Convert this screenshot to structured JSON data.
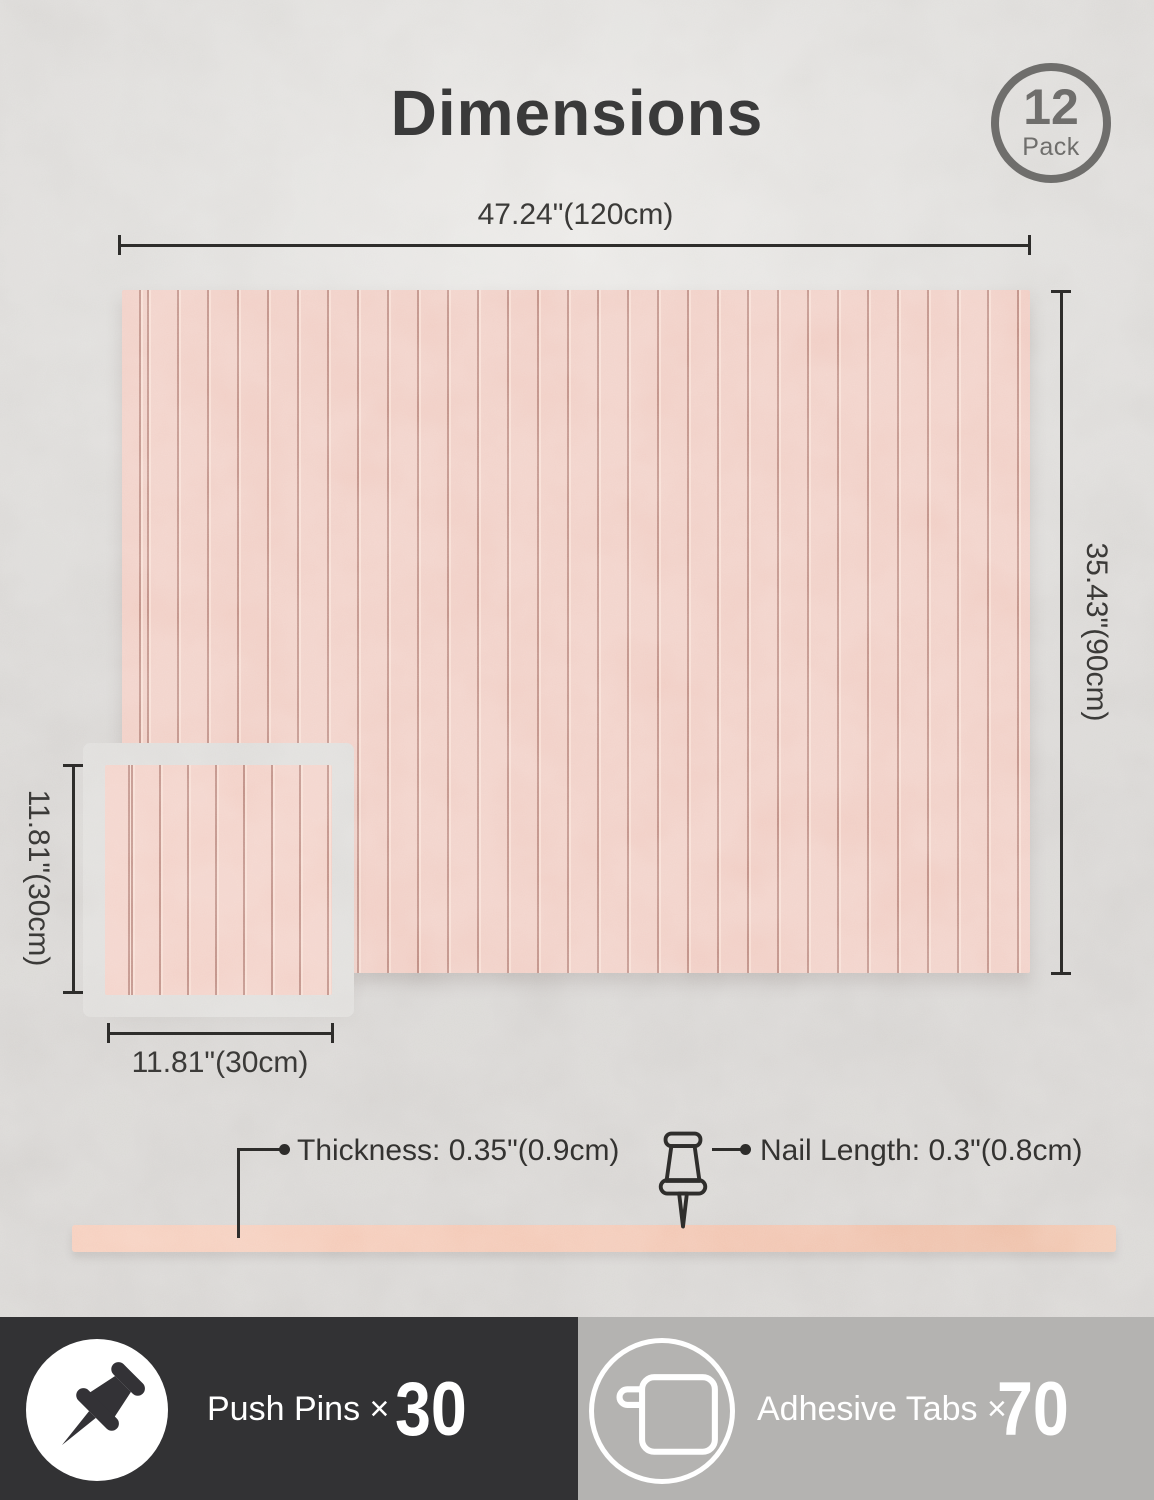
{
  "title": "Dimensions",
  "badge": {
    "count": "12",
    "unit": "Pack"
  },
  "large_panel": {
    "width_label": "47.24\"(120cm)",
    "height_label": "35.43\"(90cm)"
  },
  "small_panel": {
    "side_label": "11.81\"(30cm)",
    "bottom_label": "11.81\"(30cm)"
  },
  "callouts": {
    "thickness_label": "Thickness: 0.35\"(0.9cm)",
    "nail_length_label": "Nail Length: 0.3\"(0.8cm)"
  },
  "footer": {
    "push_pins": {
      "label": "Push Pins ×",
      "count": "30",
      "icon": "pushpin-icon"
    },
    "adhesive_tabs": {
      "label": "Adhesive Tabs ×",
      "count": "70",
      "icon": "adhesive-tab-icon"
    }
  },
  "colors": {
    "panel_pink": "#eec5ba",
    "panel_groove": "#b47a6e",
    "strip_peach": "#eeb79e",
    "footer_dark": "#323234",
    "footer_gray": "#b4b3b1",
    "badge_gray": "#6f6e6c",
    "line_dark": "#2e2d2b"
  }
}
